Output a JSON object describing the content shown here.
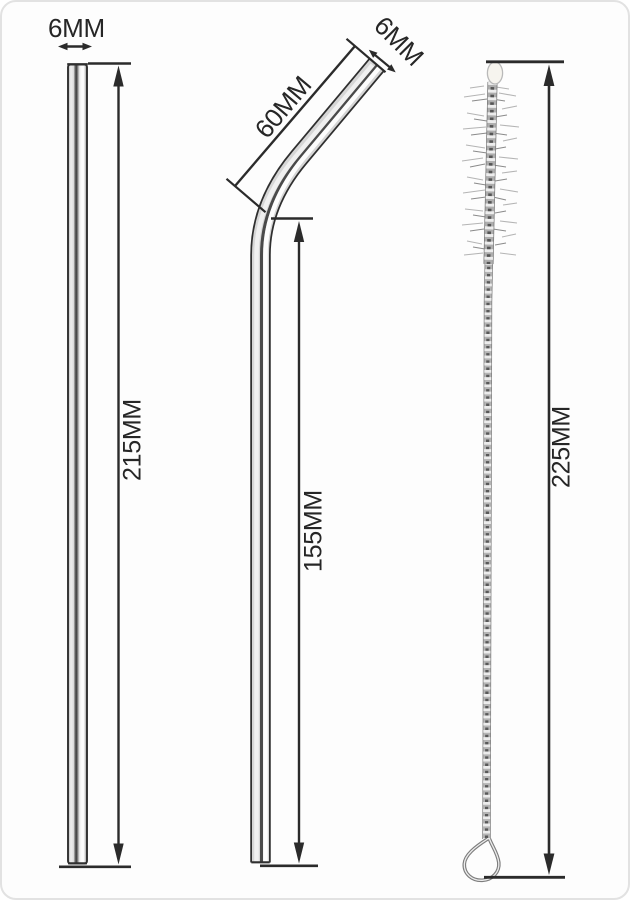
{
  "diagram": {
    "description": "Dimension diagram of two stainless steel drinking straws and a cleaning brush",
    "products": [
      {
        "name": "straight-straw",
        "labels": {
          "diameter": "6MM",
          "length": "215MM"
        }
      },
      {
        "name": "bent-straw",
        "labels": {
          "diameter": "6MM",
          "bend_section": "60MM",
          "straight_section": "155MM"
        }
      },
      {
        "name": "cleaning-brush",
        "labels": {
          "length": "225MM"
        }
      }
    ],
    "colors": {
      "line": "#2b2b2b",
      "text": "#262626",
      "background": "#fdfdfd",
      "metal_highlight": "#ffffff",
      "metal_shadow": "#3d3d3d"
    }
  }
}
